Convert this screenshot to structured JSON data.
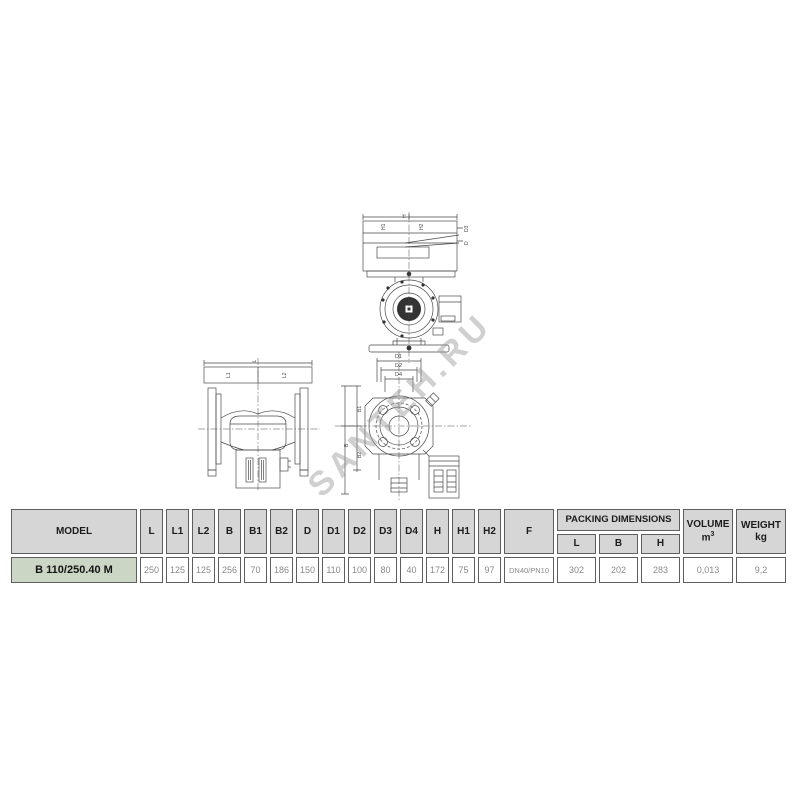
{
  "watermark": "SANTEH.RU",
  "colors": {
    "header_bg": "#d6d6d6",
    "model_row_bg": "#cbd6c4",
    "table_border": "#5e5e5e",
    "drawing_line": "#4a4a4a",
    "value_text": "#8a8a8a",
    "watermark_gray": "#969696"
  },
  "drawings": {
    "elevation": {
      "labels": {
        "top": "H",
        "inner_left": "H1",
        "inner_right": "H2",
        "right_top": "D3",
        "right_bottom": "D"
      }
    },
    "side": {
      "labels": {
        "total": "L",
        "left": "L1",
        "right": "L2"
      }
    },
    "flange": {
      "labels": {
        "d1": "D1",
        "d2": "D2",
        "d4": "D4",
        "b1": "B1",
        "b": "B",
        "b2": "B2"
      }
    }
  },
  "table": {
    "header": {
      "model": "MODEL",
      "dims": [
        "L",
        "L1",
        "L2",
        "B",
        "B1",
        "B2",
        "D",
        "D1",
        "D2",
        "D3",
        "D4",
        "H",
        "H1",
        "H2",
        "F"
      ],
      "packing": "PACKING DIMENSIONS",
      "packing_sub": [
        "L",
        "B",
        "H"
      ],
      "volume": "VOLUME",
      "volume_unit": "m",
      "volume_sup": "3",
      "weight": "WEIGHT",
      "weight_unit": "kg"
    },
    "row": {
      "model": "B 110/250.40 M",
      "dims": [
        "250",
        "125",
        "125",
        "256",
        "70",
        "186",
        "150",
        "110",
        "100",
        "80",
        "40",
        "172",
        "75",
        "97",
        "DN40/PN10"
      ],
      "packing": [
        "302",
        "202",
        "283"
      ],
      "volume": "0,013",
      "weight": "9,2"
    }
  }
}
